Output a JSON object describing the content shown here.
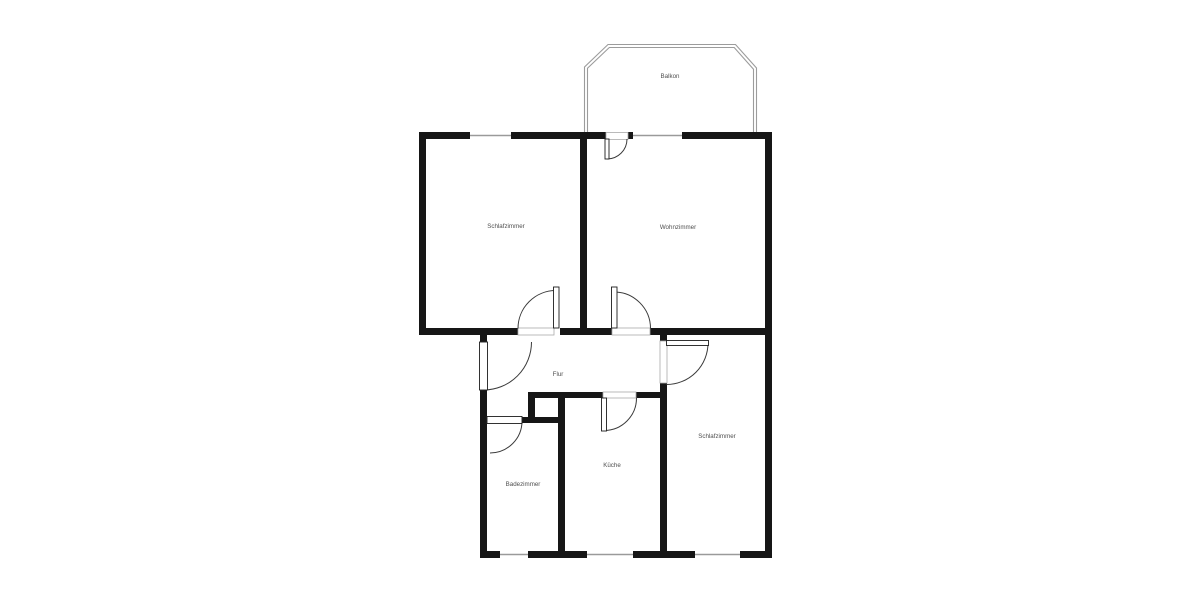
{
  "page": {
    "background": "#ffffff"
  },
  "floorplan": {
    "colors": {
      "wall": "#161616",
      "window_line": "#9a9a9a",
      "door_frame": "#aaaaaa",
      "door_leaf_stroke": "#1c1c1c",
      "door_arc": "#3a3a3a",
      "balcony_line": "#9c9c9c",
      "label": "#4f4f4f"
    },
    "label_font_size": 6.2,
    "rooms": [
      {
        "id": "balkon",
        "label": "Balkon",
        "x": 670,
        "y": 78
      },
      {
        "id": "schlafzimmer-1",
        "label": "Schlafzimmer",
        "x": 506,
        "y": 228
      },
      {
        "id": "wohnzimmer",
        "label": "Wohnzimmer",
        "x": 678,
        "y": 229
      },
      {
        "id": "flur",
        "label": "Flur",
        "x": 558,
        "y": 376
      },
      {
        "id": "kueche",
        "label": "Küche",
        "x": 612,
        "y": 467
      },
      {
        "id": "badezimmer",
        "label": "Badezimmer",
        "x": 523,
        "y": 486
      },
      {
        "id": "schlafzimmer-2",
        "label": "Schlafzimmer",
        "x": 717,
        "y": 438
      }
    ],
    "walls": [
      [
        419,
        132,
        51,
        7
      ],
      [
        511,
        132,
        95,
        7
      ],
      [
        628,
        132,
        5,
        7
      ],
      [
        682,
        132,
        90,
        7
      ],
      [
        419,
        132,
        7,
        203
      ],
      [
        765,
        132,
        7,
        426
      ],
      [
        580,
        139,
        7,
        189
      ],
      [
        419,
        328,
        99,
        7
      ],
      [
        560,
        328,
        52,
        7
      ],
      [
        650,
        328,
        122,
        7
      ],
      [
        480,
        335,
        7,
        7
      ],
      [
        480,
        390,
        7,
        168
      ],
      [
        528,
        392,
        75,
        6
      ],
      [
        636,
        392,
        31,
        6
      ],
      [
        528,
        392,
        7,
        31
      ],
      [
        522,
        417,
        43,
        6
      ],
      [
        558,
        392,
        7,
        166
      ],
      [
        660,
        328,
        7,
        13
      ],
      [
        660,
        383,
        7,
        175
      ],
      [
        480,
        551,
        20,
        7
      ],
      [
        528,
        551,
        59,
        7
      ],
      [
        633,
        551,
        62,
        7
      ],
      [
        740,
        551,
        32,
        7
      ]
    ],
    "windows": [
      {
        "x1": 470,
        "y1": 135.5,
        "x2": 511,
        "y2": 135.5
      },
      {
        "x1": 633,
        "y1": 135.5,
        "x2": 682,
        "y2": 135.5
      },
      {
        "x1": 500,
        "y1": 554.5,
        "x2": 528,
        "y2": 554.5
      },
      {
        "x1": 587,
        "y1": 554.5,
        "x2": 633,
        "y2": 554.5
      },
      {
        "x1": 695,
        "y1": 554.5,
        "x2": 740,
        "y2": 554.5
      }
    ],
    "doors": [
      {
        "id": "balkon-door",
        "opening": [
          606,
          132.5,
          22,
          7
        ],
        "leaf": [
          605,
          139,
          4,
          20
        ],
        "arc": {
          "cx": 607,
          "cy": 139,
          "r": 20,
          "a1": 0,
          "a2": 90,
          "sweep": 1
        }
      },
      {
        "id": "schlafzimmer-1-door",
        "opening": [
          518,
          328,
          36,
          7
        ],
        "leaf": [
          553.5,
          287,
          5.5,
          41
        ],
        "arc": {
          "cx": 556,
          "cy": 328.5,
          "r": 38,
          "a1": -90,
          "a2": 180,
          "sweep": 0
        }
      },
      {
        "id": "wohnzimmer-door",
        "opening": [
          612,
          328,
          38,
          7
        ],
        "leaf": [
          611.5,
          287,
          5.5,
          41
        ],
        "arc": {
          "cx": 614,
          "cy": 328.5,
          "r": 36.5,
          "a1": -90,
          "a2": 0,
          "sweep": 1
        }
      },
      {
        "id": "entry-door",
        "opening": [
          480,
          342,
          7,
          48
        ],
        "leaf": [
          479.5,
          342,
          8,
          48
        ],
        "arc": {
          "cx": 483.5,
          "cy": 342,
          "r": 48,
          "a1": 0,
          "a2": 90,
          "sweep": 1
        }
      },
      {
        "id": "badezimmer-door",
        "opening": [
          487,
          417,
          35,
          6
        ],
        "leaf": [
          487,
          416.5,
          35,
          7
        ],
        "arc": {
          "cx": 490,
          "cy": 421,
          "r": 32,
          "a1": 0,
          "a2": 90,
          "sweep": 1
        }
      },
      {
        "id": "kueche-door",
        "opening": [
          603,
          392,
          33,
          6
        ],
        "leaf": [
          601.5,
          398,
          5,
          33
        ],
        "arc": {
          "cx": 604,
          "cy": 398,
          "r": 32.5,
          "a1": 90,
          "a2": 0,
          "sweep": 0
        }
      },
      {
        "id": "schlafzimmer-2-door",
        "opening": [
          660,
          341,
          7,
          42
        ],
        "leaf": [
          666.5,
          340.5,
          42,
          5
        ],
        "arc": {
          "cx": 666.5,
          "cy": 343,
          "r": 41.5,
          "a1": 0,
          "a2": 90,
          "sweep": 1
        }
      }
    ],
    "balcony": {
      "outer": [
        [
          584.5,
          132
        ],
        [
          584.5,
          67
        ],
        [
          608,
          44.5
        ],
        [
          735.5,
          44.5
        ],
        [
          756.5,
          68
        ],
        [
          756.5,
          132
        ]
      ],
      "inner": [
        [
          587.5,
          132
        ],
        [
          587.5,
          68.2
        ],
        [
          609.3,
          47.5
        ],
        [
          734.2,
          47.5
        ],
        [
          753.5,
          69.2
        ],
        [
          753.5,
          132
        ]
      ]
    }
  }
}
